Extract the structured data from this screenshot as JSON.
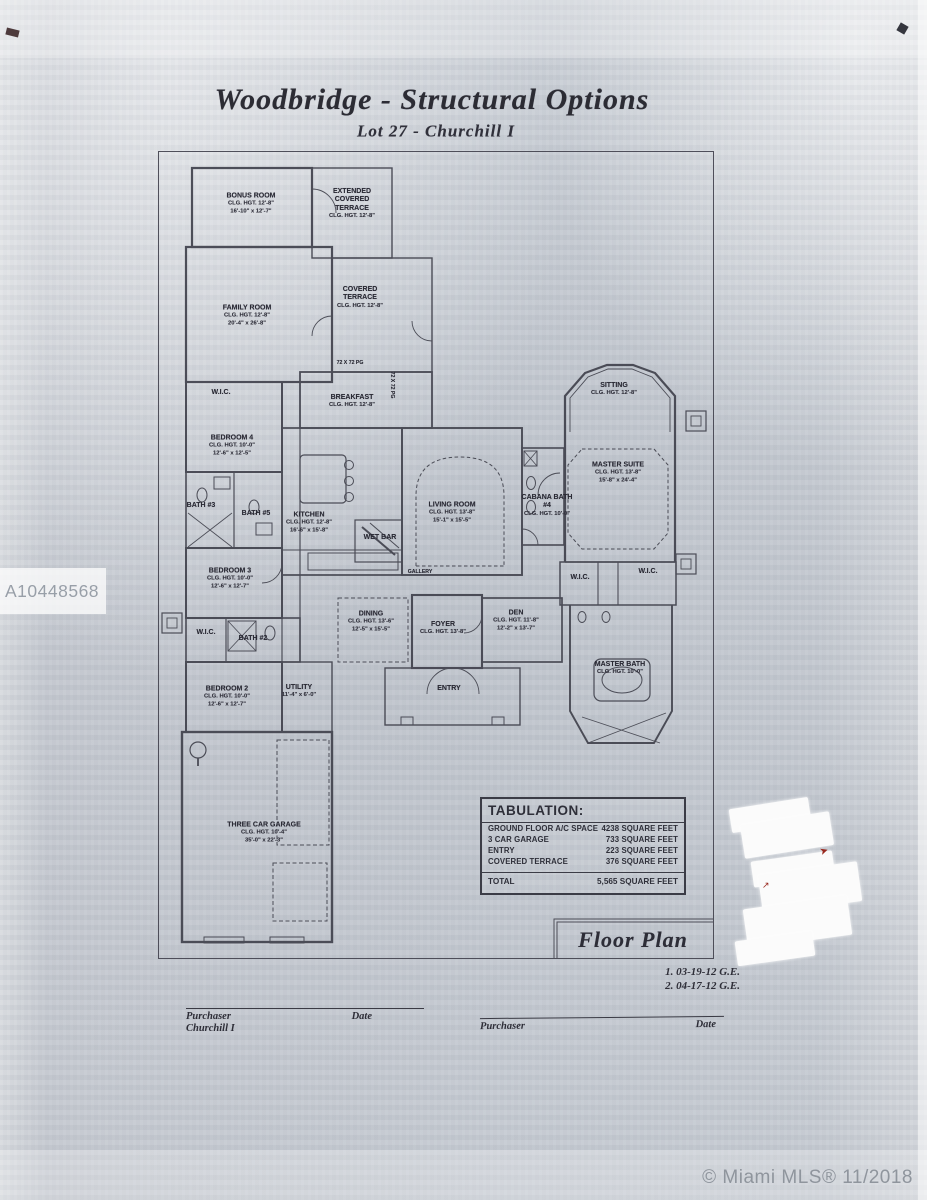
{
  "document": {
    "title": "Woodbridge - Structural Options",
    "subtitle": "Lot 27 - Churchill I",
    "floor_plan_label": "Floor Plan",
    "revisions": [
      "1. 03-19-12 G.E.",
      "2. 04-17-12 G.E."
    ],
    "watermark": "A10448568",
    "mls_stamp": "© Miami MLS® 11/2018"
  },
  "rooms": [
    {
      "name": "BONUS ROOM",
      "clg": "CLG. HGT. 12'-8\"",
      "dims": "16'-10\" x 12'-7\""
    },
    {
      "name": "EXTENDED COVERED TERRACE",
      "clg": "CLG. HGT. 12'-8\""
    },
    {
      "name": "COVERED TERRACE",
      "clg": "CLG. HGT. 12'-8\""
    },
    {
      "name": "FAMILY ROOM",
      "clg": "CLG. HGT. 12'-8\"",
      "dims": "20'-4\" x 26'-8\""
    },
    {
      "name": "W.I.C."
    },
    {
      "name": "BREAKFAST",
      "clg": "CLG. HGT. 12'-8\""
    },
    {
      "name": "BEDROOM 4",
      "clg": "CLG. HGT. 10'-0\"",
      "dims": "12'-6\" x 12'-5\""
    },
    {
      "name": "BATH #3"
    },
    {
      "name": "BATH #5"
    },
    {
      "name": "KITCHEN",
      "clg": "CLG. HGT. 12'-8\"",
      "dims": "16'-6\" x 15'-8\""
    },
    {
      "name": "WET BAR"
    },
    {
      "name": "LIVING ROOM",
      "clg": "CLG. HGT. 13'-8\"",
      "dims": "15'-1\" x 15'-5\""
    },
    {
      "name": "CABANA BATH #4",
      "clg": "CLG. HGT. 10'-0\""
    },
    {
      "name": "SITTING",
      "clg": "CLG. HGT. 12'-8\""
    },
    {
      "name": "MASTER SUITE",
      "clg": "CLG. HGT. 13'-8\"",
      "dims": "15'-8\" x 24'-4\""
    },
    {
      "name": "W.I.C."
    },
    {
      "name": "W.I.C."
    },
    {
      "name": "BEDROOM 3",
      "clg": "CLG. HGT. 10'-0\"",
      "dims": "12'-6\" x 12'-7\""
    },
    {
      "name": "W.I.C."
    },
    {
      "name": "BATH #2"
    },
    {
      "name": "DINING",
      "clg": "CLG. HGT. 13'-6\"",
      "dims": "12'-5\" x 15'-5\""
    },
    {
      "name": "FOYER",
      "clg": "CLG. HGT. 13'-8\""
    },
    {
      "name": "DEN",
      "clg": "CLG. HGT. 11'-8\"",
      "dims": "12'-2\" x 13'-7\""
    },
    {
      "name": "MASTER BATH",
      "clg": "CLG. HGT. 10'-0\""
    },
    {
      "name": "BEDROOM 2",
      "clg": "CLG. HGT. 10'-0\"",
      "dims": "12'-6\" x 12'-7\""
    },
    {
      "name": "UTILITY",
      "dims": "11'-4\" x 6'-0\""
    },
    {
      "name": "ENTRY"
    },
    {
      "name": "GALLERY"
    },
    {
      "name": "THREE CAR GARAGE",
      "clg": "CLG. HGT. 10'-4\"",
      "dims": "35'-0\" x 22'-3\""
    }
  ],
  "annotations": {
    "pg_note": "72 X 72 PG",
    "pg_note_vertical": "72 X 72 PG",
    "red_mark_1": "➤",
    "red_mark_2": "↗"
  },
  "tabulation": {
    "title": "TABULATION:",
    "rows": [
      {
        "label": "GROUND FLOOR A/C SPACE",
        "value": "4238 SQUARE FEET"
      },
      {
        "label": "3 CAR GARAGE",
        "value": "733 SQUARE FEET"
      },
      {
        "label": "ENTRY",
        "value": "223 SQUARE FEET"
      },
      {
        "label": "COVERED TERRACE",
        "value": "376 SQUARE FEET"
      }
    ],
    "total": {
      "label": "TOTAL",
      "value": "5,565 SQUARE FEET"
    }
  },
  "signatures": {
    "left": {
      "role": "Purchaser",
      "model": "Churchill I",
      "date_label": "Date"
    },
    "right": {
      "role": "Purchaser",
      "date_label": "Date"
    }
  }
}
